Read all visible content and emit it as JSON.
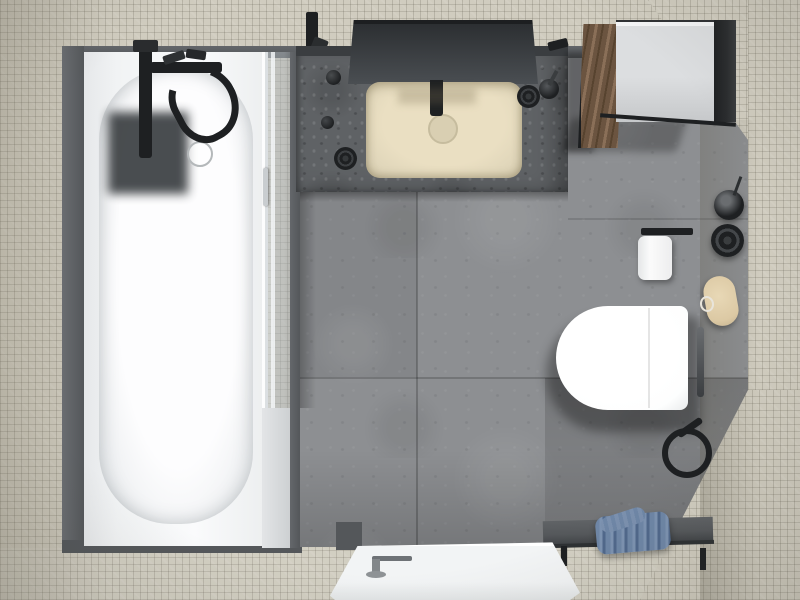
{
  "scene": {
    "title": "Top-down 3D render of a modern bathroom",
    "view": "overhead floor-plan perspective",
    "room_label": "bathroom"
  },
  "palette": {
    "mosaic": "#d0ccbf",
    "mosaicDark": "#c3bfb1",
    "grayBand": "#8b8d8f",
    "frameDark": "#54575a",
    "floor": "#8d8f92",
    "floorGrout": "#737578",
    "counter": "#5f6265",
    "backsplash": "#3a3d40",
    "mirror": "#2c2f32",
    "sink": "#e0d6ba",
    "sinkEdge": "#c6bc9e",
    "tubDeck": "#f1f3f4",
    "basin": "#fdfdfe",
    "tubMat": "#3c4043",
    "fixtureBlack": "#1e2022",
    "chrome": "#c9cdd0",
    "glass": "#dfe3e6",
    "wood": "#6b5440",
    "woodLight": "#8a6f58",
    "cabinetTop": "#dcdee0",
    "cabinetSide": "#2b2d2f",
    "toilet": "#fdfefe",
    "paperRoll": "#fbfbfb",
    "loofah": "#dcc9a4",
    "benchTop": "#55585b",
    "towel": "#6e86a6",
    "towelDark": "#50688b",
    "tray": "#f2f4f5"
  },
  "objects": {
    "bathtub": {
      "label": "white built-in bathtub"
    },
    "bath_mixer": {
      "label": "black wall-mounted bath mixer with hand shower"
    },
    "tub_mat": {
      "label": "dark square shelf shadow in tub"
    },
    "tub_drain": {
      "label": "tub drain ring"
    },
    "shower_screen": {
      "label": "glass shower screen"
    },
    "vanity_counter": {
      "label": "stone vanity counter"
    },
    "mirror": {
      "label": "wall mirror"
    },
    "sink": {
      "label": "beige square countertop basin"
    },
    "sink_tap": {
      "label": "black wall-mounted basin tap"
    },
    "counter_accessories": {
      "label": "black counter accessories"
    },
    "cabinet": {
      "label": "open wall cabinet with wood door"
    },
    "toilet": {
      "label": "white wall-hung toilet"
    },
    "toilet_paper": {
      "label": "toilet paper holder"
    },
    "grab_bar": {
      "label": "black wall rail"
    },
    "shower_valve": {
      "label": "black round shower valve"
    },
    "wall_accessories": {
      "label": "black tumbler and knobs"
    },
    "loofah": {
      "label": "oval bath sponge"
    },
    "bench": {
      "label": "dark shower bench"
    },
    "towel": {
      "label": "folded blue towel"
    },
    "shower_tray": {
      "label": "white shower tray with drain"
    },
    "walls": {
      "label": "mosaic tile walls"
    },
    "floor": {
      "label": "large grey tile floor"
    }
  }
}
